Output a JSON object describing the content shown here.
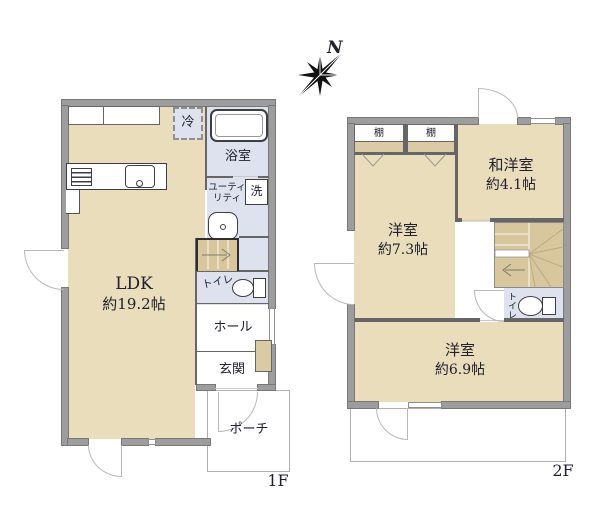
{
  "colors": {
    "floor-tan": "#e9ddbb",
    "wet-blue": "#dde2ee",
    "wall-gray": "#9d9d9d",
    "wall-edge": "#787878",
    "stairs-tan": "#d8c69c",
    "shelf-tan": "#dbcba4",
    "line": "#666666",
    "ink": "#20202e"
  },
  "compass": {
    "north_label": "N"
  },
  "floor1": {
    "label": "1F",
    "ldk": {
      "name": "LDK",
      "area": "約19.2帖"
    },
    "bathroom": {
      "name": "浴室"
    },
    "utility": {
      "line1": "ユーティ",
      "line2": "リティ"
    },
    "washer": {
      "label": "洗"
    },
    "refrigerator": {
      "label": "冷"
    },
    "toilet": {
      "label": "トイレ"
    },
    "hall": {
      "name": "ホール"
    },
    "entrance": {
      "name": "玄関"
    },
    "porch": {
      "name": "ポーチ"
    }
  },
  "floor2": {
    "label": "2F",
    "shelf_left": {
      "label": "棚"
    },
    "shelf_right": {
      "label": "棚"
    },
    "western_room_1": {
      "name": "洋室",
      "area": "約7.3帖"
    },
    "japanese_western_room": {
      "name": "和洋室",
      "area": "約4.1帖"
    },
    "western_room_2": {
      "name": "洋室",
      "area": "約6.9帖"
    },
    "toilet": {
      "label": "トイレ"
    }
  }
}
